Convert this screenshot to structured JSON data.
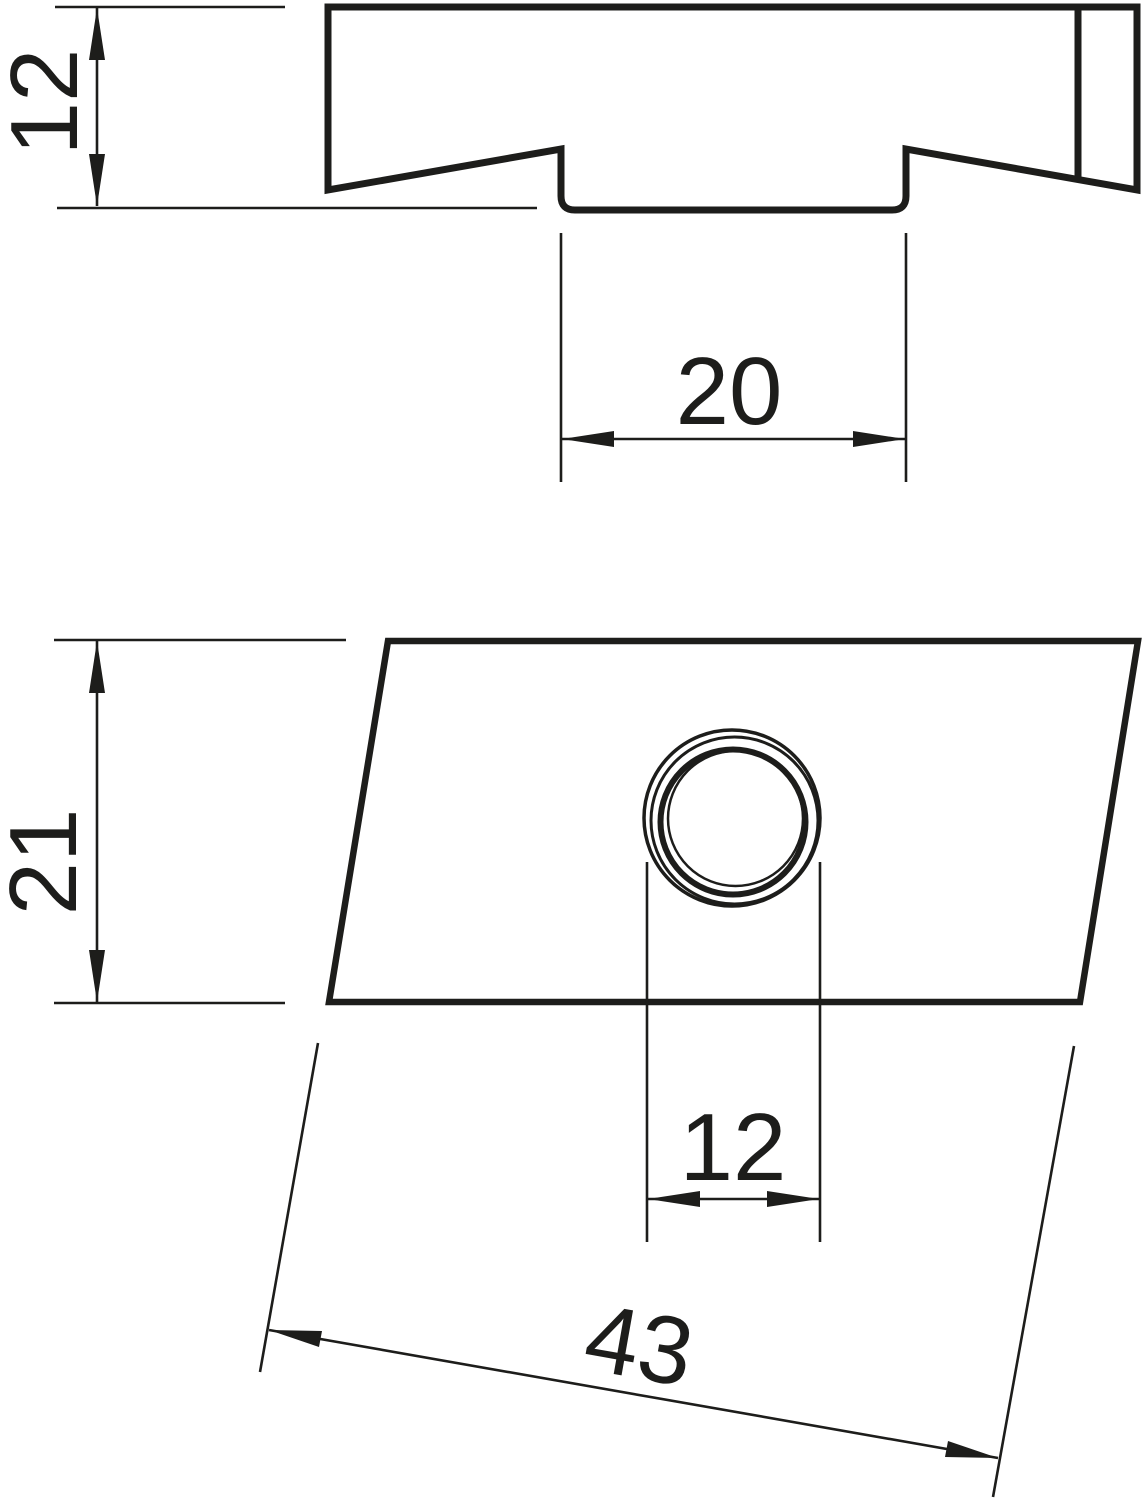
{
  "drawing": {
    "background_color": "#ffffff",
    "line_color": "#1d1d1b",
    "views": {
      "side_view": {
        "dim_height": "12",
        "dim_slot_width": "20"
      },
      "plan_view": {
        "dim_depth": "21",
        "dim_hole_diameter": "12",
        "dim_length": "43"
      }
    }
  }
}
